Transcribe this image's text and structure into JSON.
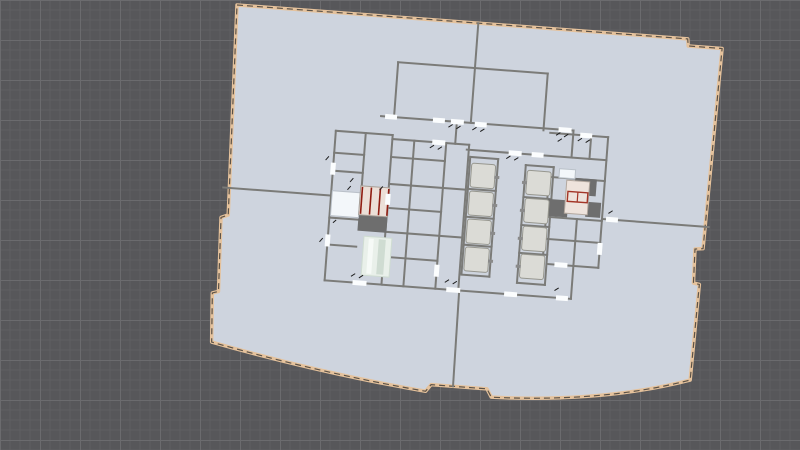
{
  "canvas": {
    "width": 800,
    "height": 450
  },
  "viewport": {
    "background": "#57575a",
    "grid": {
      "minor": 10,
      "major": 40,
      "minor_color": "#5f5f62",
      "major_color": "#6b6b6e"
    }
  },
  "plan": {
    "origin": [
      237,
      5
    ],
    "rotation_deg": 4.3,
    "colors": {
      "floor": "#ced4de",
      "boundary_band": "#e5c29c",
      "boundary_dash": "#5c5247",
      "wall": "#7b7b78",
      "poche": "#6e6e6e",
      "door": "#fbfdfe",
      "cab_fill": "#dbdbd6",
      "cab_stroke": "#97978f",
      "sill": "#8a8a8a",
      "stair_fill": "#ecdfd7",
      "stair_stroke": "#a8a098",
      "stair_red": "#8f1d12",
      "red_outline": "#a33527",
      "room_white": "#f3f7fa",
      "room_white_stroke": "#bac1c9",
      "room_pink": "#eee3dc",
      "room_pink_stroke": "#b3a89f",
      "shaft_green": "#e9f0ea",
      "shaft_green_stripe": "#cfdcd2",
      "shaft_green_light": "#f6faf7",
      "tick": "#1c1c1c"
    },
    "outline_path": "M 0 0 L 452 0 L 453 7 L 487 7 L 483 208 L 475 209 L 476 243 L 482 244 L 480 340 Q 395 369 283 372 L 278 364 L 222 364 L 217 371 Q 112 361 0 338 L -3 289 L 3 287 L 0 213 L 7 210 Z",
    "walls": [
      [
        242,
        0,
        242,
        45
      ],
      [
        165,
        45,
        315,
        45
      ],
      [
        165,
        45,
        165,
        100
      ],
      [
        315,
        45,
        315,
        102
      ],
      [
        242,
        45,
        242,
        100
      ],
      [
        152,
        100,
        345,
        100
      ],
      [
        0,
        183,
        108,
        183
      ],
      [
        380,
        186,
        487,
        186
      ],
      [
        243,
        270,
        244,
        364
      ],
      [
        228,
        100,
        228,
        122
      ],
      [
        108,
        118,
        108,
        268
      ],
      [
        108,
        118,
        165,
        118
      ],
      [
        108,
        268,
        355,
        268
      ],
      [
        240,
        127,
        380,
        127
      ],
      [
        380,
        104,
        380,
        235
      ],
      [
        108,
        140,
        138,
        140
      ],
      [
        108,
        158,
        138,
        158
      ],
      [
        138,
        118,
        138,
        171
      ],
      [
        165,
        118,
        165,
        268
      ],
      [
        108,
        205,
        137,
        205
      ],
      [
        108,
        232,
        137,
        232
      ],
      [
        187,
        122,
        187,
        268
      ],
      [
        219,
        122,
        219,
        268
      ],
      [
        242,
        122,
        242,
        268
      ],
      [
        165,
        122,
        242,
        122
      ],
      [
        165,
        140,
        219,
        140
      ],
      [
        165,
        167,
        242,
        167
      ],
      [
        165,
        191,
        219,
        191
      ],
      [
        165,
        215,
        242,
        215
      ],
      [
        165,
        240,
        219,
        240
      ],
      [
        244,
        134,
        272,
        134
      ],
      [
        244,
        134,
        244,
        252
      ],
      [
        272,
        134,
        272,
        252
      ],
      [
        244,
        252,
        272,
        252
      ],
      [
        244,
        166,
        272,
        166
      ],
      [
        244,
        194,
        272,
        194
      ],
      [
        244,
        222,
        272,
        222
      ],
      [
        300,
        138,
        328,
        138
      ],
      [
        300,
        138,
        300,
        256
      ],
      [
        328,
        138,
        328,
        256
      ],
      [
        300,
        256,
        328,
        256
      ],
      [
        300,
        170,
        328,
        170
      ],
      [
        300,
        198,
        328,
        198
      ],
      [
        300,
        226,
        328,
        226
      ],
      [
        322,
        104,
        380,
        104
      ],
      [
        345,
        100,
        345,
        127
      ],
      [
        363,
        104,
        363,
        127
      ],
      [
        324,
        148,
        380,
        148
      ],
      [
        324,
        148,
        324,
        188
      ],
      [
        324,
        188,
        380,
        188
      ],
      [
        324,
        188,
        324,
        235
      ],
      [
        330,
        235,
        380,
        235
      ],
      [
        355,
        188,
        355,
        235
      ],
      [
        324,
        210,
        380,
        210
      ],
      [
        355,
        235,
        355,
        268
      ]
    ],
    "poche_blocks": [
      [
        137,
        200,
        29,
        16
      ],
      [
        350,
        147,
        22,
        17
      ],
      [
        324,
        170,
        21,
        17
      ],
      [
        363,
        170,
        15,
        15
      ]
    ],
    "rooms": [
      {
        "t": "white",
        "r": [
          109,
          178,
          28,
          25
        ]
      },
      {
        "t": "white",
        "r": [
          334,
          139,
          16,
          9
        ]
      },
      {
        "t": "pink",
        "r": [
          342,
          150,
          23,
          33
        ]
      },
      {
        "t": "stair",
        "r": [
          137,
          171,
          29,
          29
        ]
      },
      {
        "t": "green",
        "r": [
          144,
          221,
          28,
          39
        ]
      }
    ],
    "green_stripes": [
      [
        149,
        223,
        5,
        35
      ],
      [
        159,
        223,
        7,
        35
      ]
    ],
    "stair_lines": {
      "xs": [
        138.8,
        147.8,
        156.8,
        165.2
      ],
      "y1": 172,
      "y2": 199
    },
    "red_outline_rect": [
      344,
      161,
      20,
      10
    ],
    "red_divider": [
      354,
      161,
      354,
      171
    ],
    "elevator_banks": [
      {
        "x": 246,
        "ys": [
          140,
          168,
          196,
          224
        ],
        "w": 24,
        "h": 24,
        "sill_x": 269.5
      },
      {
        "x": 302,
        "ys": [
          143,
          171,
          199,
          227
        ],
        "w": 24,
        "h": 24,
        "sill_x": 297.5
      }
    ],
    "doors": [
      [
        156,
        97.5,
        12,
        5
      ],
      [
        204,
        97.5,
        12,
        5
      ],
      [
        222,
        97.5,
        13,
        5
      ],
      [
        246,
        98.5,
        12,
        5
      ],
      [
        330,
        97.5,
        13,
        5
      ],
      [
        352,
        101.5,
        12,
        5
      ],
      [
        282,
        124.5,
        13,
        5
      ],
      [
        305,
        124.5,
        12,
        5
      ],
      [
        205,
        119.5,
        13,
        5
      ],
      [
        136,
        265.5,
        14,
        5
      ],
      [
        230,
        265.5,
        14,
        5
      ],
      [
        288,
        265.5,
        13,
        5
      ],
      [
        340,
        265.5,
        12,
        5
      ],
      [
        336,
        232.5,
        13,
        5
      ],
      [
        105.5,
        150,
        5,
        12
      ],
      [
        105.5,
        222,
        5,
        12
      ],
      [
        377.5,
        210,
        5,
        12
      ],
      [
        384,
        183.5,
        12,
        5
      ],
      [
        162.5,
        177,
        5,
        11
      ],
      [
        216.5,
        244,
        5,
        12
      ]
    ],
    "ticks": [
      [
        220,
        106,
        224,
        103
      ],
      [
        228,
        107,
        232,
        104
      ],
      [
        244,
        107,
        248,
        104
      ],
      [
        252,
        108,
        256,
        105
      ],
      [
        328,
        106,
        332,
        103
      ],
      [
        336,
        107,
        340,
        104
      ],
      [
        350,
        110,
        354,
        107
      ],
      [
        358,
        111,
        362,
        108
      ],
      [
        280,
        133,
        284,
        130
      ],
      [
        288,
        134,
        292,
        131
      ],
      [
        203,
        128,
        207,
        125
      ],
      [
        211,
        129,
        215,
        126
      ],
      [
        134,
        262,
        138,
        259
      ],
      [
        142,
        263,
        146,
        260
      ],
      [
        228,
        261,
        232,
        258
      ],
      [
        236,
        262,
        240,
        259
      ],
      [
        338,
        261,
        342,
        258
      ],
      [
        126,
        168,
        129,
        164
      ],
      [
        124,
        176,
        127,
        172
      ],
      [
        112,
        210,
        115,
        207
      ],
      [
        156,
        174,
        159,
        170
      ],
      [
        330,
        112,
        334,
        109
      ],
      [
        386,
        180,
        390,
        177
      ],
      [
        100,
        148,
        103,
        144
      ],
      [
        100,
        230,
        103,
        226
      ]
    ]
  }
}
